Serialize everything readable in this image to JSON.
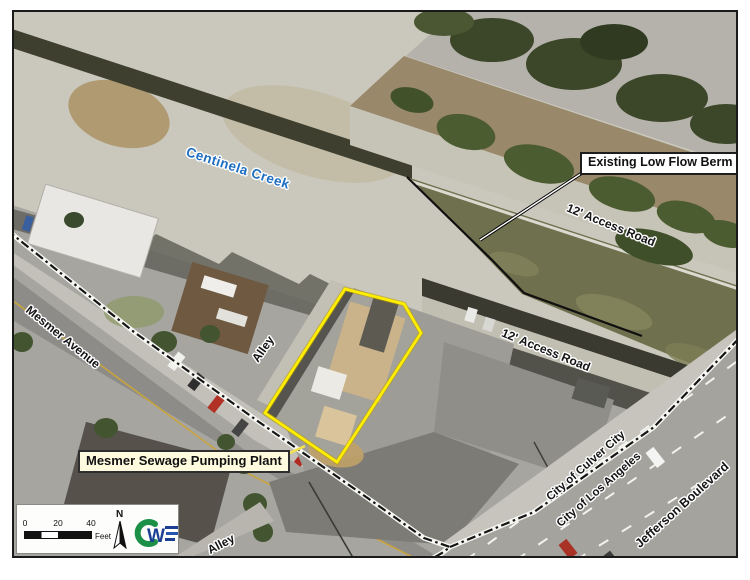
{
  "figure": {
    "type": "annotated-aerial-map",
    "labels": {
      "centinela_creek": "Centinela Creek",
      "access_road_upper": "12' Access Road",
      "access_road_lower": "12' Access Road",
      "mesmer_avenue": "Mesmer Avenue",
      "alley_upper": "Alley",
      "alley_lower": "Alley",
      "city_of_culver_city": "City of Culver City",
      "city_of_los_angeles": "City of Los Angeles",
      "jefferson_boulevard": "Jefferson Boulevard"
    },
    "callouts": {
      "existing_low_flow_berm": "Existing Low Flow Berm",
      "mesmer_sewage_pumping_plant": "Mesmer Sewage Pumping Plant"
    },
    "legend": {
      "scale_ticks": [
        "0",
        "20",
        "40"
      ],
      "scale_unit": "Feet",
      "north_label": "N",
      "logo": {
        "letter_c": "C",
        "letter_w": "W",
        "letter_e": "E"
      }
    },
    "colors": {
      "property_outline": "#ffee00",
      "creek_label_blue": "#1e6ec2",
      "plant_callout_bg": "#fffbdf",
      "logo_green": "#1d9048",
      "logo_blue": "#1c3f94"
    }
  }
}
